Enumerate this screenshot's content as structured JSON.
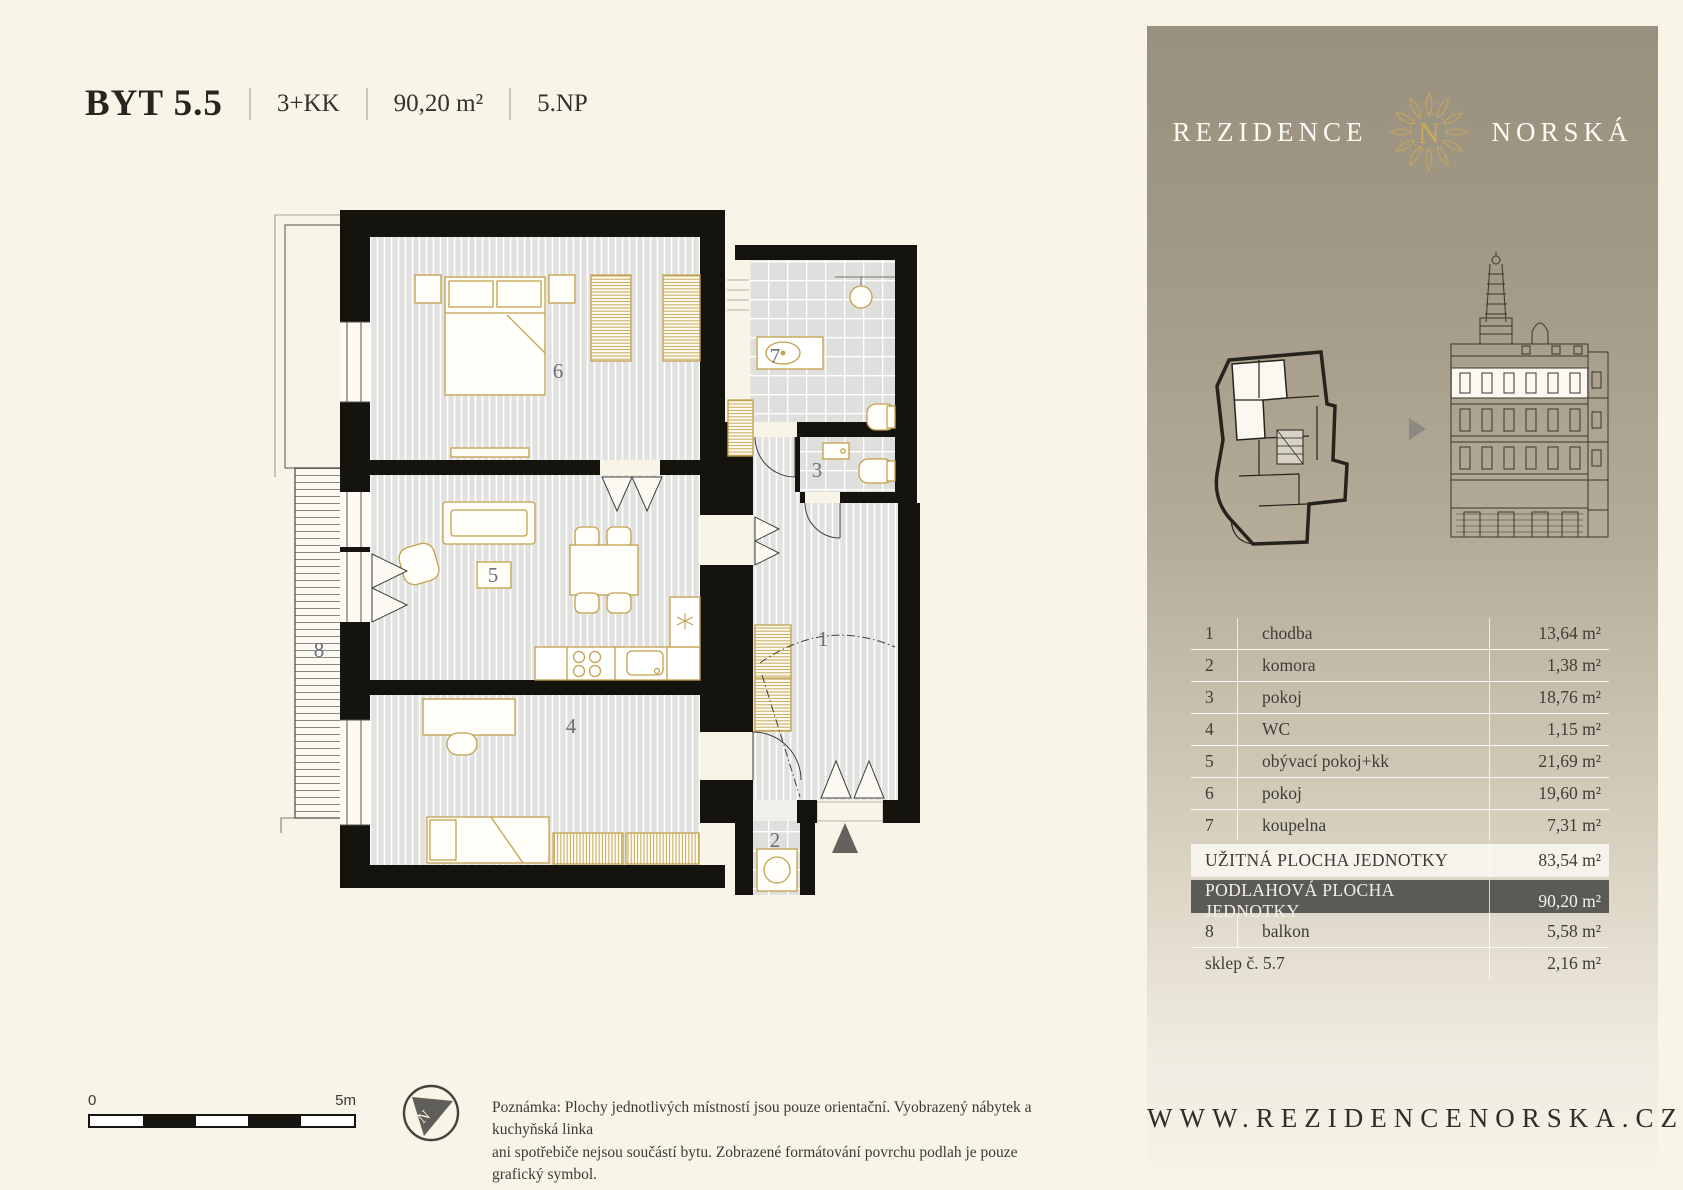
{
  "header": {
    "unit": "BYT 5.5",
    "disposition": "3+KK",
    "area": "90,20 m²",
    "floor": "5.NP"
  },
  "brand": {
    "left": "REZIDENCE",
    "right": "NORSKÁ",
    "monogram": "N"
  },
  "plan": {
    "labels": {
      "r1": "1",
      "r2": "2",
      "r3": "3",
      "r4": "4",
      "r5": "5",
      "r6": "6",
      "r7": "7",
      "r8": "8"
    }
  },
  "compass": {
    "n": "N"
  },
  "scalebar": {
    "start": "0",
    "end": "5m"
  },
  "note": {
    "line1": "Poznámka: Plochy jednotlivých místností jsou pouze orientační. Vyobrazený nábytek a kuchyňská linka",
    "line2": "ani spotřebiče nejsou součástí bytu. Zobrazené formátování povrchu podlah je pouze grafický symbol."
  },
  "sidebar": {
    "rooms": [
      {
        "num": "1",
        "label": "chodba",
        "area": "13,64 m²"
      },
      {
        "num": "2",
        "label": "komora",
        "area": "1,38 m²"
      },
      {
        "num": "3",
        "label": "pokoj",
        "area": "18,76 m²"
      },
      {
        "num": "4",
        "label": "WC",
        "area": "1,15 m²"
      },
      {
        "num": "5",
        "label": "obývací pokoj+kk",
        "area": "21,69 m²"
      },
      {
        "num": "6",
        "label": "pokoj",
        "area": "19,60 m²"
      },
      {
        "num": "7",
        "label": "koupelna",
        "area": "7,31 m²"
      }
    ],
    "summary_useful": {
      "label": "UŽITNÁ PLOCHA JEDNOTKY",
      "area": "83,54 m²"
    },
    "summary_floor": {
      "label": "PODLAHOVÁ PLOCHA JEDNOTKY",
      "area": "90,20 m²"
    },
    "balcony": {
      "num": "8",
      "label": "balkon",
      "area": "5,58 m²"
    },
    "cellar": {
      "label": "sklep č. 5.7",
      "area": "2,16 m²"
    },
    "website": "WWW.REZIDENCENORSKA.CZ"
  },
  "colors": {
    "cream": "#F8F4E7",
    "wall": "#14130D",
    "gold": "#C2A14F",
    "sidebar_top": "#99907F",
    "summary_dark": "#5B5A55",
    "summary_light": "#F5F3EC",
    "floor_gray": "#E1E1DF",
    "accent_gray": "#63625D"
  }
}
